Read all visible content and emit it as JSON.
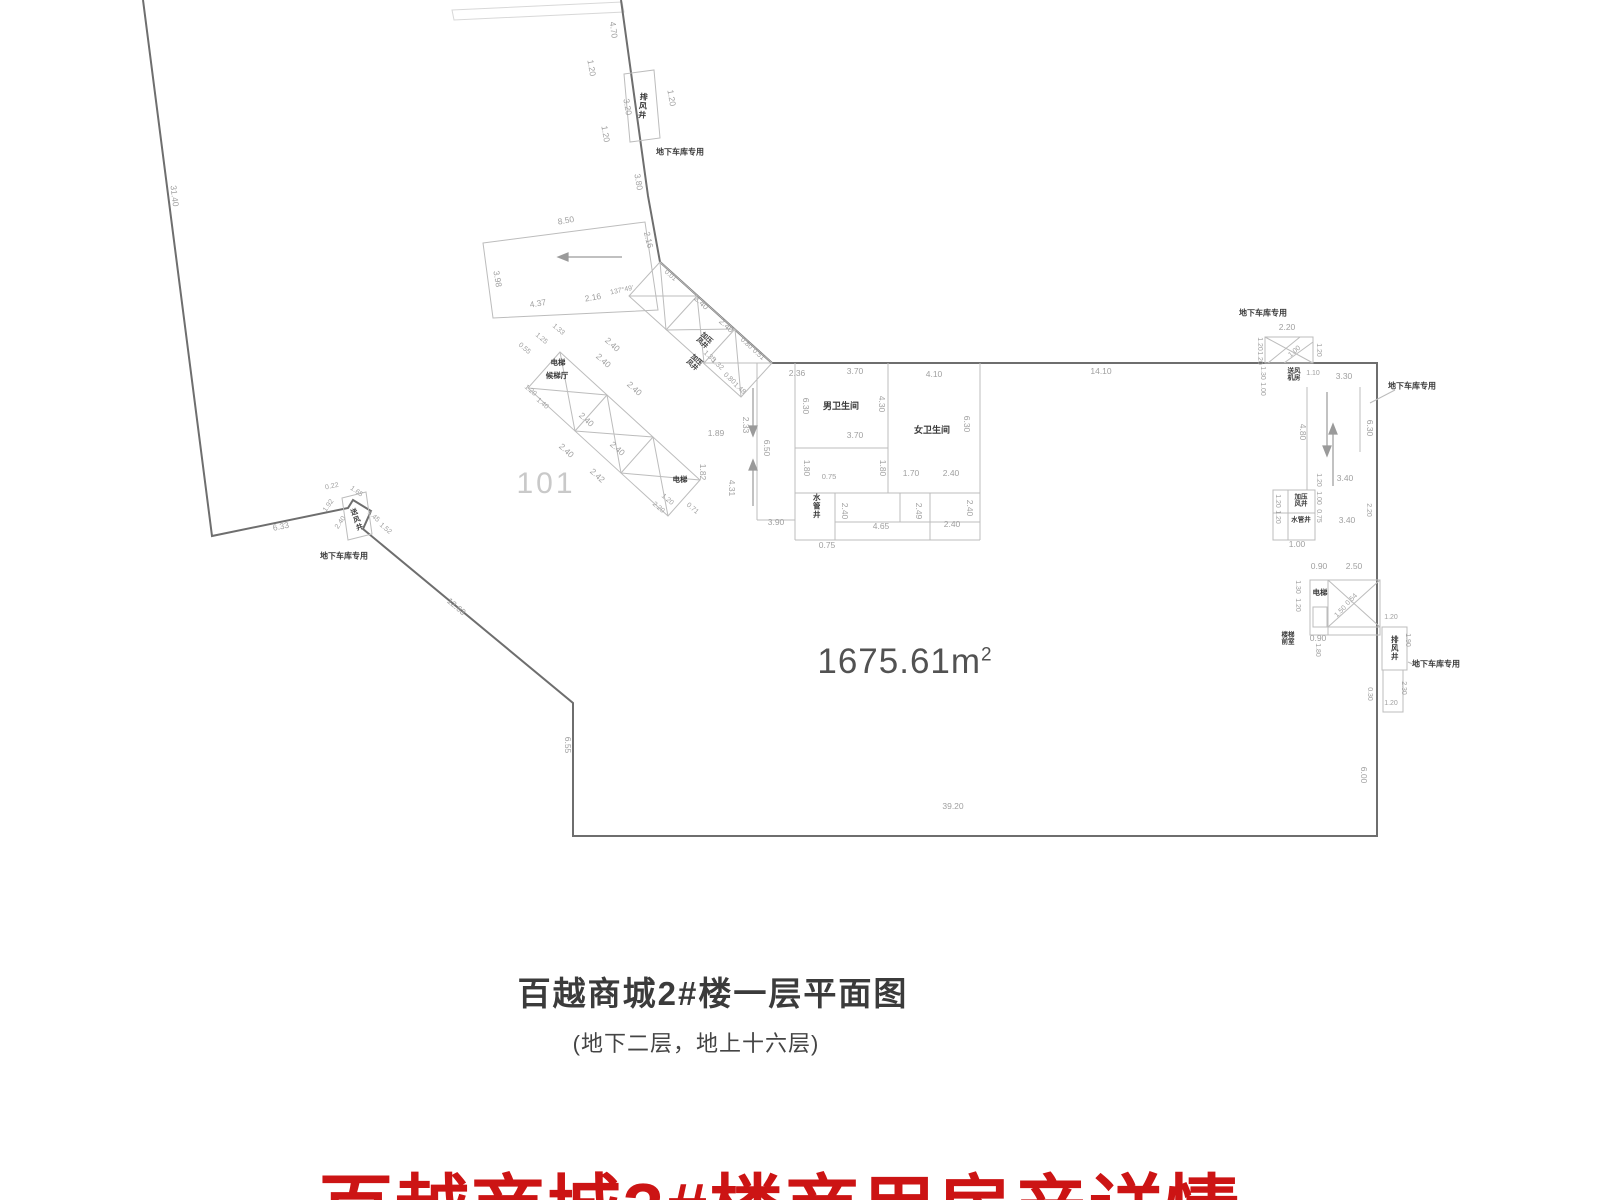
{
  "plan": {
    "room_number": "101",
    "area_value": "1675.61m",
    "area_sup": "2",
    "room_labels": [
      {
        "t": "排风井",
        "x": 642,
        "y": 106,
        "v": 1,
        "r": 5,
        "s": 8
      },
      {
        "t": "地下车库专用",
        "x": 680,
        "y": 153,
        "s": 8
      },
      {
        "t": "电梯",
        "x": 558,
        "y": 363,
        "s": 7.5
      },
      {
        "t": "候梯厅",
        "x": 557,
        "y": 376,
        "s": 7.5
      },
      {
        "t": "加压\n风井",
        "x": 704,
        "y": 341,
        "r": 42,
        "s": 6.5
      },
      {
        "t": "加压\n风井",
        "x": 694,
        "y": 363,
        "r": 42,
        "s": 6.5
      },
      {
        "t": "电梯",
        "x": 680,
        "y": 480,
        "s": 7.5
      },
      {
        "t": "男卫生间",
        "x": 841,
        "y": 406,
        "s": 9
      },
      {
        "t": "女卫生间",
        "x": 932,
        "y": 430,
        "s": 9
      },
      {
        "t": "水管井",
        "x": 816,
        "y": 506,
        "v": 1,
        "s": 7.5
      },
      {
        "t": "送风井",
        "x": 356,
        "y": 520,
        "v": 1,
        "r": -20,
        "s": 7
      },
      {
        "t": "地下车库专用",
        "x": 344,
        "y": 557,
        "s": 8
      },
      {
        "t": "地下车库专用",
        "x": 1263,
        "y": 314,
        "s": 8
      },
      {
        "t": "送风\n机房",
        "x": 1294,
        "y": 375,
        "s": 6.5
      },
      {
        "t": "地下车库专用",
        "x": 1412,
        "y": 387,
        "s": 8
      },
      {
        "t": "加压\n风井",
        "x": 1301,
        "y": 501,
        "s": 6.5
      },
      {
        "t": "水管井",
        "x": 1301,
        "y": 520,
        "s": 6.5
      },
      {
        "t": "电梯",
        "x": 1320,
        "y": 593,
        "s": 7.5
      },
      {
        "t": "楼梯\n前室",
        "x": 1288,
        "y": 639,
        "s": 6.5
      },
      {
        "t": "排风井",
        "x": 1394,
        "y": 648,
        "v": 1,
        "s": 7.5
      },
      {
        "t": "地下车库专用",
        "x": 1436,
        "y": 665,
        "s": 8
      }
    ],
    "dim_labels": [
      {
        "t": "31.40",
        "x": 174,
        "y": 196,
        "r": 83
      },
      {
        "t": "4.70",
        "x": 613,
        "y": 30,
        "r": 83
      },
      {
        "t": "1.20",
        "x": 591,
        "y": 68,
        "r": 80
      },
      {
        "t": "3.20",
        "x": 627,
        "y": 107,
        "r": 80
      },
      {
        "t": "1.20",
        "x": 605,
        "y": 134,
        "r": 80
      },
      {
        "t": "1.20",
        "x": 671,
        "y": 98,
        "r": 80
      },
      {
        "t": "3.80",
        "x": 638,
        "y": 182,
        "r": 80
      },
      {
        "t": "8.50",
        "x": 566,
        "y": 221,
        "r": -10
      },
      {
        "t": "2.16",
        "x": 648,
        "y": 240,
        "r": 76
      },
      {
        "t": "3.98",
        "x": 497,
        "y": 279,
        "r": 80
      },
      {
        "t": "4.37",
        "x": 538,
        "y": 304,
        "r": -10
      },
      {
        "t": "2.16",
        "x": 593,
        "y": 298,
        "r": -10
      },
      {
        "t": "137°49'",
        "x": 622,
        "y": 291,
        "r": -12,
        "s": 7
      },
      {
        "t": "0.01",
        "x": 670,
        "y": 276,
        "r": 40,
        "s": 7
      },
      {
        "t": "2.40",
        "x": 701,
        "y": 303,
        "r": 42
      },
      {
        "t": "2.40",
        "x": 726,
        "y": 326,
        "r": 42
      },
      {
        "t": "0.80",
        "x": 746,
        "y": 344,
        "r": 42,
        "s": 7
      },
      {
        "t": "0.51",
        "x": 758,
        "y": 355,
        "r": 42,
        "s": 7
      },
      {
        "t": "1.35",
        "x": 709,
        "y": 357,
        "r": 42,
        "s": 7
      },
      {
        "t": "1.32",
        "x": 717,
        "y": 365,
        "r": 42,
        "s": 7
      },
      {
        "t": "0.80",
        "x": 729,
        "y": 379,
        "r": 42,
        "s": 7
      },
      {
        "t": "1.48",
        "x": 739,
        "y": 389,
        "r": 42,
        "s": 7
      },
      {
        "t": "2.40",
        "x": 612,
        "y": 345,
        "r": 42
      },
      {
        "t": "2.40",
        "x": 603,
        "y": 361,
        "r": 42
      },
      {
        "t": "2.40",
        "x": 634,
        "y": 389,
        "r": 42
      },
      {
        "t": "2.40",
        "x": 586,
        "y": 420,
        "r": 42
      },
      {
        "t": "2.40",
        "x": 617,
        "y": 449,
        "r": 42
      },
      {
        "t": "2.42",
        "x": 597,
        "y": 476,
        "r": 42
      },
      {
        "t": "2.40",
        "x": 566,
        "y": 451,
        "r": 42
      },
      {
        "t": "0.55",
        "x": 524,
        "y": 349,
        "r": 40,
        "s": 7
      },
      {
        "t": "1.25",
        "x": 541,
        "y": 339,
        "r": 40,
        "s": 7
      },
      {
        "t": "1.33",
        "x": 558,
        "y": 330,
        "r": 40,
        "s": 7
      },
      {
        "t": "1.20",
        "x": 530,
        "y": 391,
        "r": 40,
        "s": 7
      },
      {
        "t": "1.40",
        "x": 542,
        "y": 404,
        "r": 40,
        "s": 7
      },
      {
        "t": "1.89",
        "x": 716,
        "y": 434
      },
      {
        "t": "1.82",
        "x": 702,
        "y": 472,
        "r": 90
      },
      {
        "t": "1.20",
        "x": 667,
        "y": 500,
        "r": 40,
        "s": 7
      },
      {
        "t": "2.20",
        "x": 658,
        "y": 508,
        "r": 40,
        "s": 7
      },
      {
        "t": "0.71",
        "x": 692,
        "y": 509,
        "r": 40,
        "s": 7
      },
      {
        "t": "4.31",
        "x": 731,
        "y": 488,
        "r": 90
      },
      {
        "t": "2.33",
        "x": 745,
        "y": 425,
        "r": 90
      },
      {
        "t": "6.50",
        "x": 766,
        "y": 448,
        "r": 90
      },
      {
        "t": "3.90",
        "x": 776,
        "y": 523
      },
      {
        "t": "0.75",
        "x": 829,
        "y": 477,
        "s": 7.5
      },
      {
        "t": "0.75",
        "x": 827,
        "y": 546
      },
      {
        "t": "2.40",
        "x": 844,
        "y": 511,
        "r": 90
      },
      {
        "t": "4.65",
        "x": 881,
        "y": 527
      },
      {
        "t": "2.49",
        "x": 918,
        "y": 511,
        "r": 90
      },
      {
        "t": "2.40",
        "x": 952,
        "y": 525
      },
      {
        "t": "2.40",
        "x": 969,
        "y": 508,
        "r": 90
      },
      {
        "t": "1.70",
        "x": 911,
        "y": 474
      },
      {
        "t": "2.40",
        "x": 951,
        "y": 474
      },
      {
        "t": "1.80",
        "x": 806,
        "y": 468,
        "r": 90
      },
      {
        "t": "1.80",
        "x": 882,
        "y": 468,
        "r": 90
      },
      {
        "t": "2.36",
        "x": 797,
        "y": 374
      },
      {
        "t": "3.70",
        "x": 855,
        "y": 372
      },
      {
        "t": "3.70",
        "x": 855,
        "y": 436
      },
      {
        "t": "4.30",
        "x": 881,
        "y": 404,
        "r": 90
      },
      {
        "t": "6.30",
        "x": 805,
        "y": 406,
        "r": 90
      },
      {
        "t": "4.10",
        "x": 934,
        "y": 375
      },
      {
        "t": "6.30",
        "x": 966,
        "y": 424,
        "r": 90
      },
      {
        "t": "14.10",
        "x": 1101,
        "y": 372
      },
      {
        "t": "6.33",
        "x": 281,
        "y": 527,
        "r": -12
      },
      {
        "t": "0.22",
        "x": 332,
        "y": 487,
        "r": -12,
        "s": 7
      },
      {
        "t": "1.65",
        "x": 356,
        "y": 492,
        "r": 35,
        "s": 7
      },
      {
        "t": "1.92",
        "x": 329,
        "y": 506,
        "r": -55,
        "s": 7
      },
      {
        "t": "2.40",
        "x": 341,
        "y": 523,
        "r": -55,
        "s": 7
      },
      {
        "t": "1.45",
        "x": 373,
        "y": 517,
        "r": 40,
        "s": 7
      },
      {
        "t": "1.52",
        "x": 385,
        "y": 529,
        "r": 40,
        "s": 7
      },
      {
        "t": "12.63",
        "x": 456,
        "y": 607,
        "r": 40
      },
      {
        "t": "6.55",
        "x": 567,
        "y": 745,
        "r": 90
      },
      {
        "t": "39.20",
        "x": 953,
        "y": 807
      },
      {
        "t": "6.00",
        "x": 1363,
        "y": 775,
        "r": 90
      },
      {
        "t": "2.20",
        "x": 1287,
        "y": 328
      },
      {
        "t": "1.20",
        "x": 1259,
        "y": 344,
        "r": 90,
        "s": 7
      },
      {
        "t": "1.20",
        "x": 1259,
        "y": 358,
        "r": 90,
        "s": 7
      },
      {
        "t": "1.00",
        "x": 1295,
        "y": 352,
        "r": -40,
        "s": 7
      },
      {
        "t": "1.20",
        "x": 1318,
        "y": 350,
        "r": 90,
        "s": 7
      },
      {
        "t": "1.30",
        "x": 1262,
        "y": 373,
        "r": 90,
        "s": 7
      },
      {
        "t": "1.00",
        "x": 1262,
        "y": 389,
        "r": 90,
        "s": 7
      },
      {
        "t": "1.10",
        "x": 1313,
        "y": 374,
        "s": 7
      },
      {
        "t": "3.30",
        "x": 1344,
        "y": 377
      },
      {
        "t": "4.80",
        "x": 1302,
        "y": 432,
        "r": 90
      },
      {
        "t": "6.30",
        "x": 1369,
        "y": 428,
        "r": 90
      },
      {
        "t": "3.40",
        "x": 1345,
        "y": 479
      },
      {
        "t": "1.20",
        "x": 1277,
        "y": 501,
        "r": 90,
        "s": 7
      },
      {
        "t": "1.20",
        "x": 1277,
        "y": 517,
        "r": 90,
        "s": 7
      },
      {
        "t": "1.20",
        "x": 1318,
        "y": 480,
        "r": 90,
        "s": 7
      },
      {
        "t": "1.00",
        "x": 1318,
        "y": 498,
        "r": 90,
        "s": 7
      },
      {
        "t": "0.75",
        "x": 1318,
        "y": 516,
        "r": 90,
        "s": 7
      },
      {
        "t": "3.40",
        "x": 1347,
        "y": 521
      },
      {
        "t": "2.20",
        "x": 1368,
        "y": 510,
        "r": 90,
        "s": 7
      },
      {
        "t": "1.00",
        "x": 1297,
        "y": 545
      },
      {
        "t": "0.90",
        "x": 1319,
        "y": 567
      },
      {
        "t": "2.50",
        "x": 1354,
        "y": 567
      },
      {
        "t": "1.30",
        "x": 1297,
        "y": 587,
        "r": 90,
        "s": 7
      },
      {
        "t": "1.20",
        "x": 1297,
        "y": 605,
        "r": 90,
        "s": 7
      },
      {
        "t": "0.54",
        "x": 1352,
        "y": 600,
        "r": -45,
        "s": 7
      },
      {
        "t": "1.50",
        "x": 1341,
        "y": 612,
        "r": -45,
        "s": 7
      },
      {
        "t": "0.90",
        "x": 1318,
        "y": 639
      },
      {
        "t": "1.80",
        "x": 1317,
        "y": 650,
        "r": 90,
        "s": 7
      },
      {
        "t": "0.30",
        "x": 1369,
        "y": 694,
        "r": 90,
        "s": 7
      },
      {
        "t": "1.20",
        "x": 1391,
        "y": 618,
        "s": 7
      },
      {
        "t": "1.90",
        "x": 1407,
        "y": 640,
        "r": 90,
        "s": 7
      },
      {
        "t": "2.30",
        "x": 1403,
        "y": 688,
        "r": 90,
        "s": 7
      },
      {
        "t": "1.20",
        "x": 1391,
        "y": 704,
        "s": 7
      }
    ]
  },
  "caption": {
    "title": "百越商城2#楼一层平面图",
    "subtitle": "(地下二层，地上十六层)"
  },
  "footer_title": "百越商城3#楼商用房产详情",
  "colors": {
    "accent_red": "#cc1414"
  }
}
